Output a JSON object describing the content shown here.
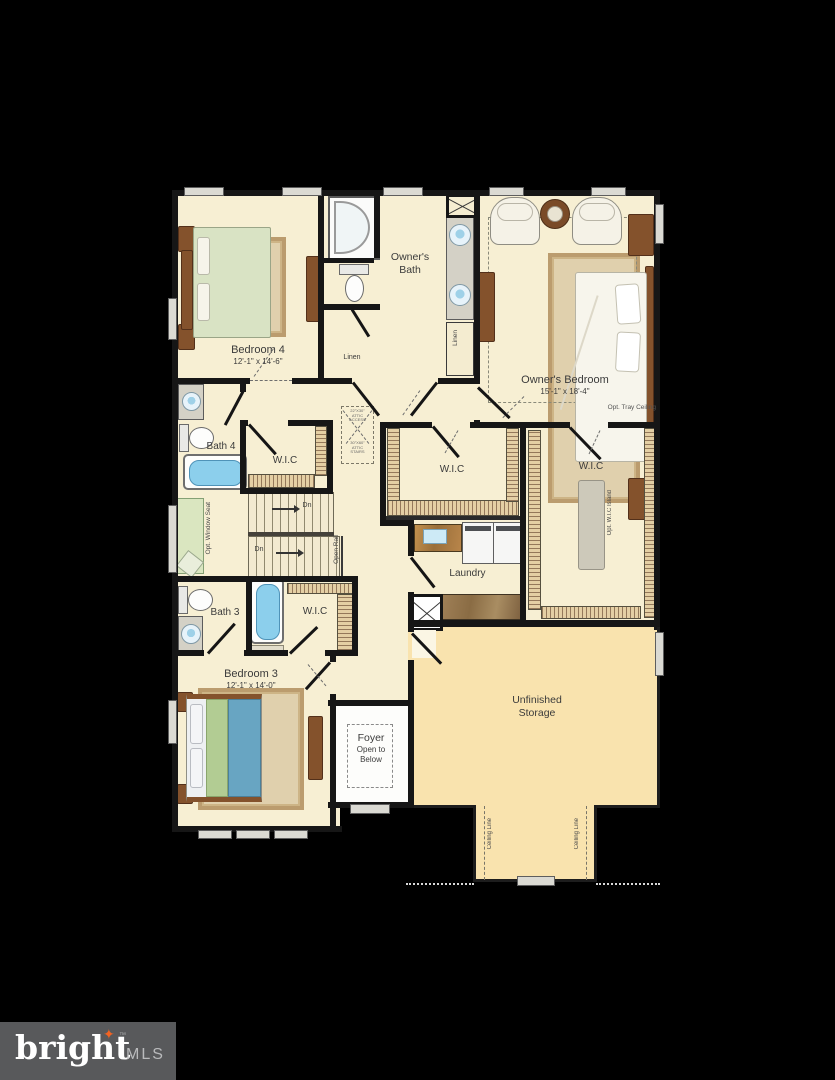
{
  "logo": {
    "brand": "bright",
    "tm": "™",
    "suffix": "MLS"
  },
  "rooms": {
    "bedroom4": {
      "name": "Bedroom 4",
      "dims": "12'-1\" x 14'-6\""
    },
    "owners_bath": {
      "line1": "Owner's",
      "line2": "Bath"
    },
    "owners_bedroom": {
      "name": "Owner's Bedroom",
      "dims": "15'-1\" x 18'-4\"",
      "ceiling_note": "Opt. Tray Ceiling"
    },
    "bath4": {
      "name": "Bath 4"
    },
    "wic_hall": {
      "name": "W.I.C"
    },
    "wic_middle": {
      "name": "W.I.C"
    },
    "wic_owner": {
      "name": "W.I.C",
      "island_note": "Opt. W.I.C Island"
    },
    "laundry": {
      "name": "Laundry"
    },
    "bath3": {
      "name": "Bath 3"
    },
    "wic_bedroom3": {
      "name": "W.I.C"
    },
    "bedroom3": {
      "name": "Bedroom 3",
      "dims": "12'-1\" x 14'-0\""
    },
    "foyer": {
      "name": "Foyer",
      "note1": "Open to",
      "note2": "Below"
    },
    "storage": {
      "line1": "Unfinished",
      "line2": "Storage"
    }
  },
  "annotations": {
    "linen_left": "Linen",
    "linen_right": "Linen",
    "window_seat": "Opt. Window Seat",
    "open_rail": "Open Rail",
    "dn_upper": "Dn",
    "dn_lower": "Dn",
    "ceiling_line_left": "Ceiling Line",
    "ceiling_line_right": "Ceiling Line",
    "attic_access": {
      "l1": "22\"X30\"",
      "l2": "ATTIC",
      "l3": "ACCESS"
    },
    "attic_stairs": {
      "l1": "30\"X60\"",
      "l2": "ATTIC",
      "l3": "STAIRS"
    }
  },
  "icons": {
    "star-icon": "✦",
    "bed-icon": "css-rect",
    "toilet-icon": "css-ellipse",
    "sink-icon": "css-circle",
    "tub-icon": "css-rounded-rect",
    "shower-icon": "css-d-shape",
    "washer-icon": "css-rect",
    "dryer-icon": "css-rect",
    "stairs-icon": "css-stripes"
  },
  "colors": {
    "background": "#000000",
    "floor": "#f7efd3",
    "storage_floor": "#f9e3ae",
    "wall": "#161616",
    "tub_blue": "#8ccfec",
    "seat_green": "#dae6c0",
    "logo_bg": "#58595b",
    "logo_star_orange": "#f26322"
  }
}
